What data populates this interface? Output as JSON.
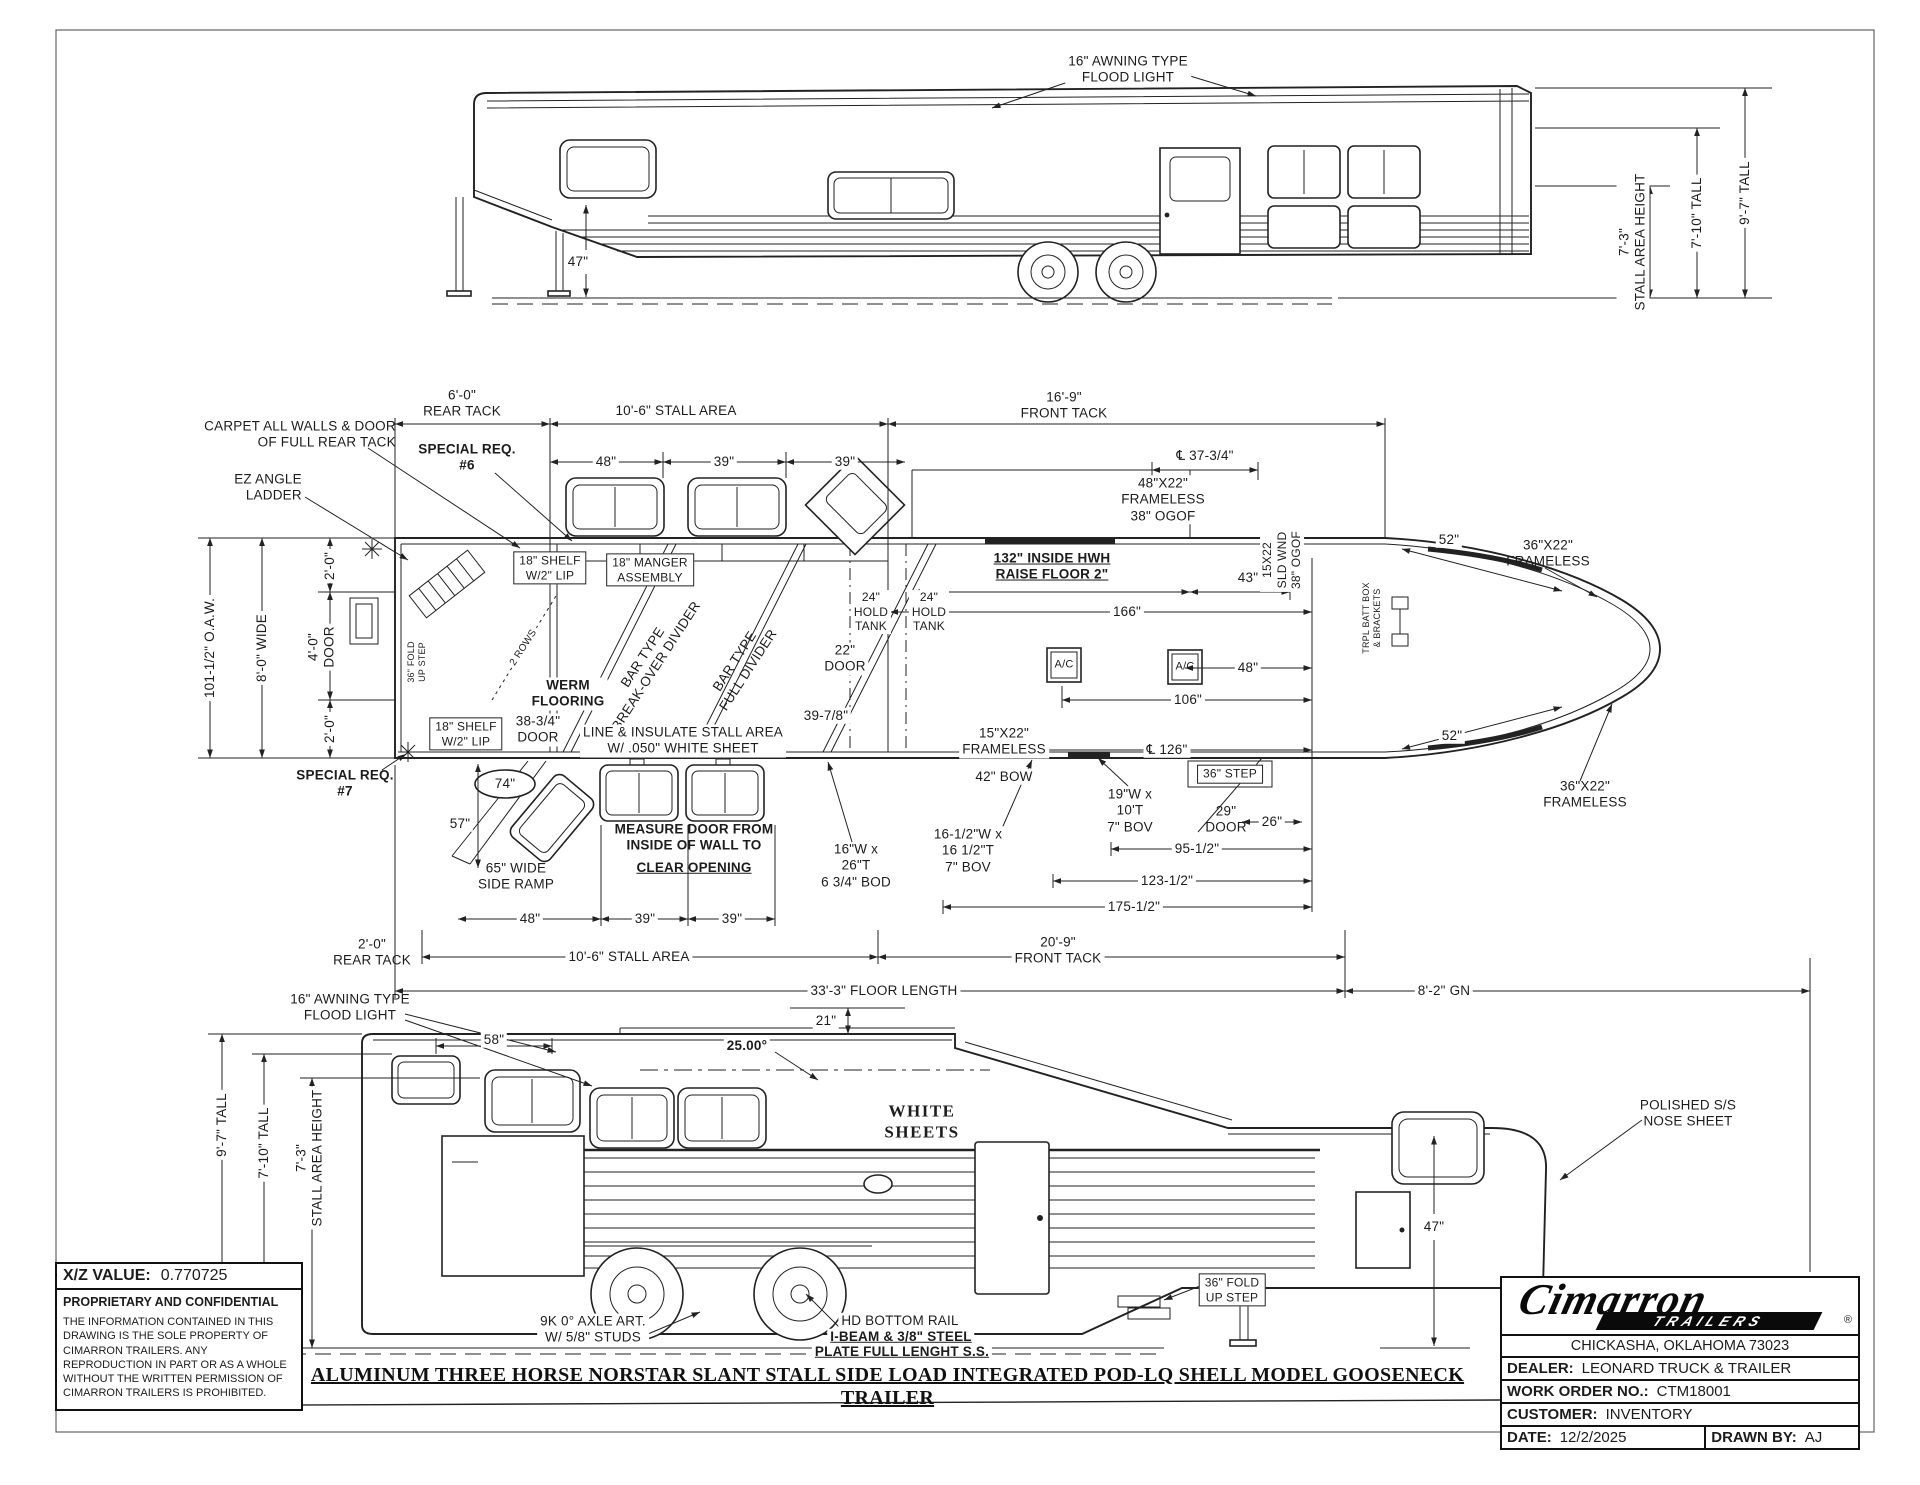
{
  "drawing_title": "ALUMINUM THREE HORSE NORSTAR SLANT STALL SIDE LOAD INTEGRATED POD-LQ SHELL MODEL GOOSENECK TRAILER",
  "info_block": {
    "xz_label": "X/Z VALUE:",
    "xz_value": "0.770725",
    "confidential_title": "PROPRIETARY AND CONFIDENTIAL",
    "confidential_text": "THE INFORMATION CONTAINED IN THIS DRAWING IS THE SOLE PROPERTY OF CIMARRON TRAILERS.  ANY REPRODUCTION IN PART OR AS A WHOLE WITHOUT THE WRITTEN PERMISSION OF CIMARRON TRAILERS IS PROHIBITED."
  },
  "title_block": {
    "brand": "Cimarron",
    "brand_sub": "TRAILERS",
    "reg_mark": "®",
    "address": "CHICKASHA, OKLAHOMA 73023",
    "dealer_label": "DEALER:",
    "dealer_value": "LEONARD TRUCK & TRAILER",
    "work_order_label": "WORK ORDER NO.:",
    "work_order_value": "CTM18001",
    "customer_label": "CUSTOMER:",
    "customer_value": "INVENTORY",
    "date_label": "DATE:",
    "date_value": "12/2/2025",
    "drawn_by_label": "DRAWN BY:",
    "drawn_by_value": "AJ"
  },
  "top_view": {
    "flood_light": "16\" AWNING TYPE\nFLOOD LIGHT",
    "gooseneck_clearance": "47\"",
    "stall_area_height": "7'-3\"\nSTALL AREA HEIGHT",
    "tall_7_10": "7'-10\" TALL",
    "tall_9_7": "9'-7\" TALL"
  },
  "floor_plan": {
    "carpet_note": "CARPET ALL WALLS & DOOR\nOF FULL REAR TACK",
    "ez_ladder": "EZ ANGLE\nLADDER",
    "special_req_6": "SPECIAL REQ.\n#6",
    "special_req_7": "SPECIAL REQ.\n#7",
    "rear_tack_top": "6'-0\"\nREAR TACK",
    "stall_area_top": "10'-6\" STALL AREA",
    "front_tack_top": "16'-9\"\nFRONT TACK",
    "win_48_top": "48\"",
    "win_39a_top": "39\"",
    "win_39b_top": "39\"",
    "cl_37_34": "℄ 37-3/4\"",
    "frameless_48x22": "48\"X22\"\nFRAMELESS\n38\" OGOF",
    "inside_hwh": "132\" INSIDE HWH\nRAISE FLOOR 2\"",
    "sld_wnd": "15X22\nSLD WND\n38\" OGOF",
    "dim_43": "43\"",
    "dim_52_top": "52\"",
    "frameless_36x22_top": "36\"X22\"\nFRAMELESS",
    "batt_box": "TRPL BATT BOX\n& BRACKETS",
    "oaw": "101-1/2\" O.A.W.",
    "width_8": "8'-0\" WIDE",
    "dim_2_0_a": "2'-0\"",
    "door_4_0": "4'-0\"\nDOOR",
    "dim_2_0_b": "2'-0\"",
    "fold_step": "36\" FOLD\nUP STEP",
    "shelf_top": "18\" SHELF\nW/2\" LIP",
    "manger_assembly": "18\" MANGER\nASSEMBLY",
    "shelf_left": "18\" SHELF\nW/2\" LIP",
    "two_rows": "2 ROWS",
    "bar_breakover": "BAR TYPE\nBREAK-OVER DIVIDER",
    "bar_full": "BAR TYPE\nFULL DIVIDER",
    "werm_flooring": "WERM\nFLOORING",
    "door_38_34": "38-3/4\"\nDOOR",
    "line_insulate": "LINE & INSULATE STALL AREA\nW/ .050\" WHITE SHEET",
    "dim_74": "74\"",
    "dim_57": "57\"",
    "side_ramp": "65\" WIDE\nSIDE RAMP",
    "measure_door_1": "MEASURE DOOR FROM\nINSIDE OF WALL TO",
    "measure_door_2": "CLEAR OPENING",
    "bod_16x26": "16\"W x\n26\"T\n6 3/4\" BOD",
    "dim_39_78": "39-7/8\"",
    "door_22": "22\"\nDOOR",
    "hold_tank_a": "24\"\nHOLD\nTANK",
    "hold_tank_b": "24\"\nHOLD\nTANK",
    "dim_166": "166\"",
    "ac_a": "A/C",
    "ac_b": "A/C",
    "dim_48_right": "48\"",
    "dim_106": "106\"",
    "frameless_15x22": "15\"X22\"\nFRAMELESS",
    "cl_126": "℄ 126\"",
    "bow_42": "42\" BOW",
    "bov_19": "19\"W x\n10'T\n7\" BOV",
    "step_36": "36\" STEP",
    "door_29": "29\"\nDOOR",
    "dim_26": "26\"",
    "dim_95_12": "95-1/2\"",
    "bov_16": "16-1/2\"W x\n16 1/2\"T\n7\" BOV",
    "dim_123_12": "123-1/2\"",
    "dim_175_12": "175-1/2\"",
    "dim_52_bottom": "52\"",
    "frameless_36x22_bottom": "36\"X22\"\nFRAMELESS",
    "win_48_bot": "48\"",
    "win_39c_bot": "39\"",
    "win_39d_bot": "39\"",
    "rear_tack_bottom": "2'-0\"\nREAR TACK",
    "stall_area_bottom": "10'-6\" STALL AREA",
    "front_tack_bottom": "20'-9\"\nFRONT TACK",
    "floor_length": "33'-3\" FLOOR LENGTH",
    "gooseneck_dim": "8'-2\" GN"
  },
  "bottom_view": {
    "flood_light": "16\" AWNING TYPE\nFLOOD LIGHT",
    "dim_58": "58\"",
    "roof_angle": "25.00°",
    "dim_21": "21\"",
    "white_sheets": "WHITE\nSHEETS",
    "tall_9_7": "9'-7\" TALL",
    "tall_7_10": "7'-10\" TALL",
    "stall_area_height": "7'-3\"\nSTALL AREA HEIGHT",
    "axle_note": "9K 0° AXLE ART.\nW/ 5/8\" STUDS",
    "rail_1": "HD BOTTOM RAIL",
    "rail_2": "I-BEAM & 3/8\" STEEL",
    "rail_3": "PLATE FULL LENGHT S.S.",
    "fold_step": "36\" FOLD\nUP STEP",
    "dim_47": "47\"",
    "nose_sheet": "POLISHED S/S\nNOSE SHEET"
  }
}
